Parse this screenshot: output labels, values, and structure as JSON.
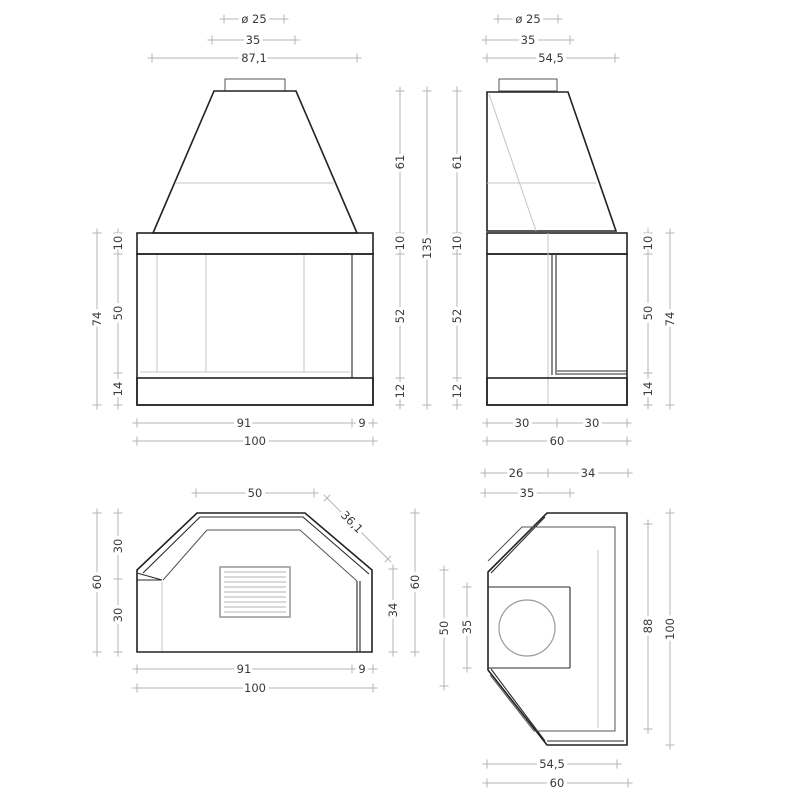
{
  "front_view": {
    "flue_dia": "ø 25",
    "collar_width": "35",
    "hood_width": "87,1",
    "band_height": "10",
    "glass_height": "50",
    "base_height": "14",
    "body_height": "74",
    "hood_height": "61",
    "band_height_r": "10",
    "glass_height_r": "52",
    "base_height_r": "12",
    "opening_width": "91",
    "glass_return": "9",
    "total_width": "100"
  },
  "side_view": {
    "flue_dia": "ø 25",
    "collar_width": "35",
    "hood_depth": "54,5",
    "total_height": "135",
    "hood_height": "61",
    "band_height": "10",
    "glass_height": "52",
    "base_height": "12",
    "band_height_r": "10",
    "glass_height_r": "50",
    "base_height_r": "14",
    "body_height": "74",
    "front_half": "30",
    "back_half": "30",
    "total_depth": "60"
  },
  "plan_front_view": {
    "top_width": "50",
    "chamfer": "36,1",
    "left_upper": "30",
    "left_lower": "30",
    "left_total": "60",
    "right_glass": "34",
    "right_total": "60",
    "opening_width": "91",
    "glass_return": "9",
    "total_width": "100"
  },
  "plan_side_view": {
    "back_depth": "26",
    "front_depth": "34",
    "firebox_depth": "35",
    "glass_span": "50",
    "firebox_width": "35",
    "inner_length": "88",
    "total_length": "100",
    "chamfer_span": "54,5",
    "total_depth": "60"
  }
}
